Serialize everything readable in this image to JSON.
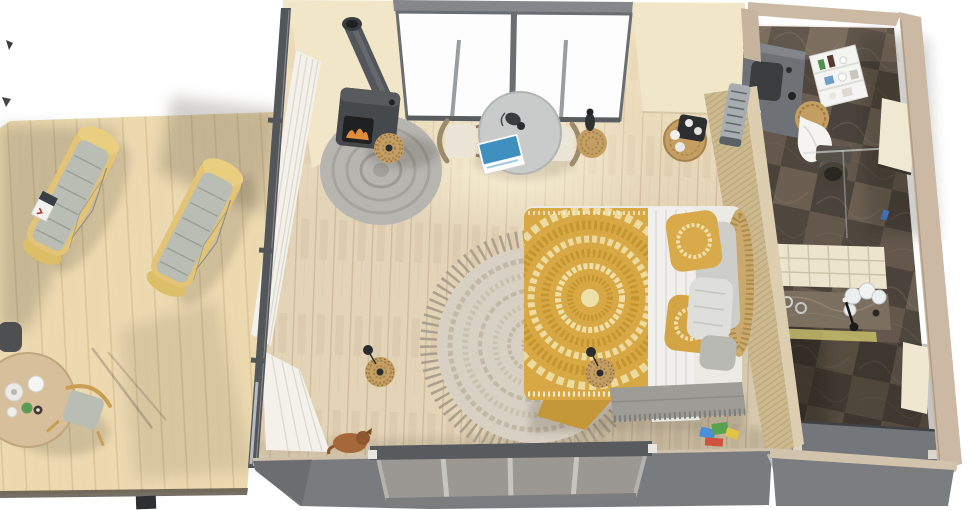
{
  "meta": {
    "type": "3d-interior-render",
    "view": "top-down aerial view",
    "width": 970,
    "height": 510,
    "caption": "Aerial 3D render of a tiny home: wooden deck with two chaise loungers and a coffee table, a studio bedroom with wood stove, round dining table and a double bed with yellow mandala duvet, and a dark-marble bathroom module"
  },
  "colors": {
    "background": "#ffffff",
    "deck_wood": "#ecd9b0",
    "deck_plank_line": "#d9c397",
    "lounger_frame": "#e3c476",
    "lounger_roll": "#eace80",
    "lounger_cushion": "#b9bdb4",
    "outdoor_table_wood": "#d7bf9b",
    "room_floor": "#e3d4b8",
    "floor_plank_line": "#c9b392",
    "wall_exterior_grey": "#797b7e",
    "wall_frame_dark": "#54575a",
    "wall_interior_cream": "#f1e7c8",
    "window_white": "#fdfdfd",
    "curtain_white": "#f3f1ea",
    "stove_body": "#46494b",
    "stove_fire": "#df8c3d",
    "braided_rug_grey": "#b7b5b0",
    "dining_table_top": "#c9cbca",
    "chair_cushion": "#ebe5d7",
    "wicker_tan": "#c49e62",
    "bed_duvet_yellow": "#d7a843",
    "bed_duvet_pattern": "#eedfa8",
    "bed_blanket_white": "#f1f0ec",
    "bed_pillow_grey": "#cdcdc9",
    "headboard_rattan": "#c9a96e",
    "fringe_rug_base": "#d8d0c2",
    "fringe_rug_ring": "#c3b8a5",
    "fringe_rug_fringe": "#a59b8a",
    "slat_wall_tan": "#cdb98f",
    "bathroom_wall_beige": "#cbb9a3",
    "marble_dark": "#5a5046",
    "marble_counter": "#7b6f60",
    "vanity_grey": "#6e7175",
    "shelf_white": "#f4f4f2",
    "ceiling_grid_cream": "#ece4cd",
    "bathroom_floor_grey": "#73767a",
    "dog_brown": "#a5683a",
    "toy_blue": "#4a90d9",
    "toy_green": "#58a34e",
    "toy_yellow": "#e2c546",
    "toy_red": "#d05340"
  },
  "scene": {
    "deck": {
      "name": "wooden-deck",
      "objects": [
        {
          "name": "chaise-lounger-left"
        },
        {
          "name": "chaise-lounger-right"
        },
        {
          "name": "magazine-on-lounger"
        },
        {
          "name": "outdoor-round-table"
        },
        {
          "name": "outdoor-chair"
        },
        {
          "name": "partial-chair-at-edge"
        },
        {
          "name": "tableware-cups-and-bottle"
        }
      ]
    },
    "bedroom": {
      "name": "bedroom-module",
      "objects": [
        {
          "name": "wood-stove-with-fire"
        },
        {
          "name": "stove-chimney-pipe"
        },
        {
          "name": "braided-round-rug"
        },
        {
          "name": "wicker-basket-lamp"
        },
        {
          "name": "white-curtains"
        },
        {
          "name": "round-dining-table"
        },
        {
          "name": "magazine-on-table"
        },
        {
          "name": "camera-on-table"
        },
        {
          "name": "dining-chair-left"
        },
        {
          "name": "dining-chair-right"
        },
        {
          "name": "wicker-side-table-with-vase"
        },
        {
          "name": "rattan-bedside-table-with-tray"
        },
        {
          "name": "ac-unit-on-wall"
        },
        {
          "name": "double-bed-yellow-mandala-duvet"
        },
        {
          "name": "white-folded-blanket"
        },
        {
          "name": "pillows"
        },
        {
          "name": "rattan-fan-headboard"
        },
        {
          "name": "grey-fringe-throw"
        },
        {
          "name": "round-fringe-rug"
        },
        {
          "name": "wicker-floor-lamp"
        },
        {
          "name": "wicker-pendant-lamp"
        },
        {
          "name": "dog-lying-down"
        },
        {
          "name": "colorful-books"
        },
        {
          "name": "glass-wall-left"
        },
        {
          "name": "window-wall-top"
        },
        {
          "name": "window-wall-bottom"
        }
      ]
    },
    "bathroom": {
      "name": "bathroom-module",
      "objects": [
        {
          "name": "vanity-with-dark-sink"
        },
        {
          "name": "wall-shelf-with-toiletries"
        },
        {
          "name": "wicker-basket-with-towels"
        },
        {
          "name": "toilet"
        },
        {
          "name": "glass-shower-screen"
        },
        {
          "name": "marble-counter-with-jars"
        },
        {
          "name": "window-upper-right"
        },
        {
          "name": "window-lower-right"
        },
        {
          "name": "suspended-ceiling-grid"
        },
        {
          "name": "water-heater-box"
        },
        {
          "name": "dark-marble-tile-walls"
        }
      ]
    }
  }
}
